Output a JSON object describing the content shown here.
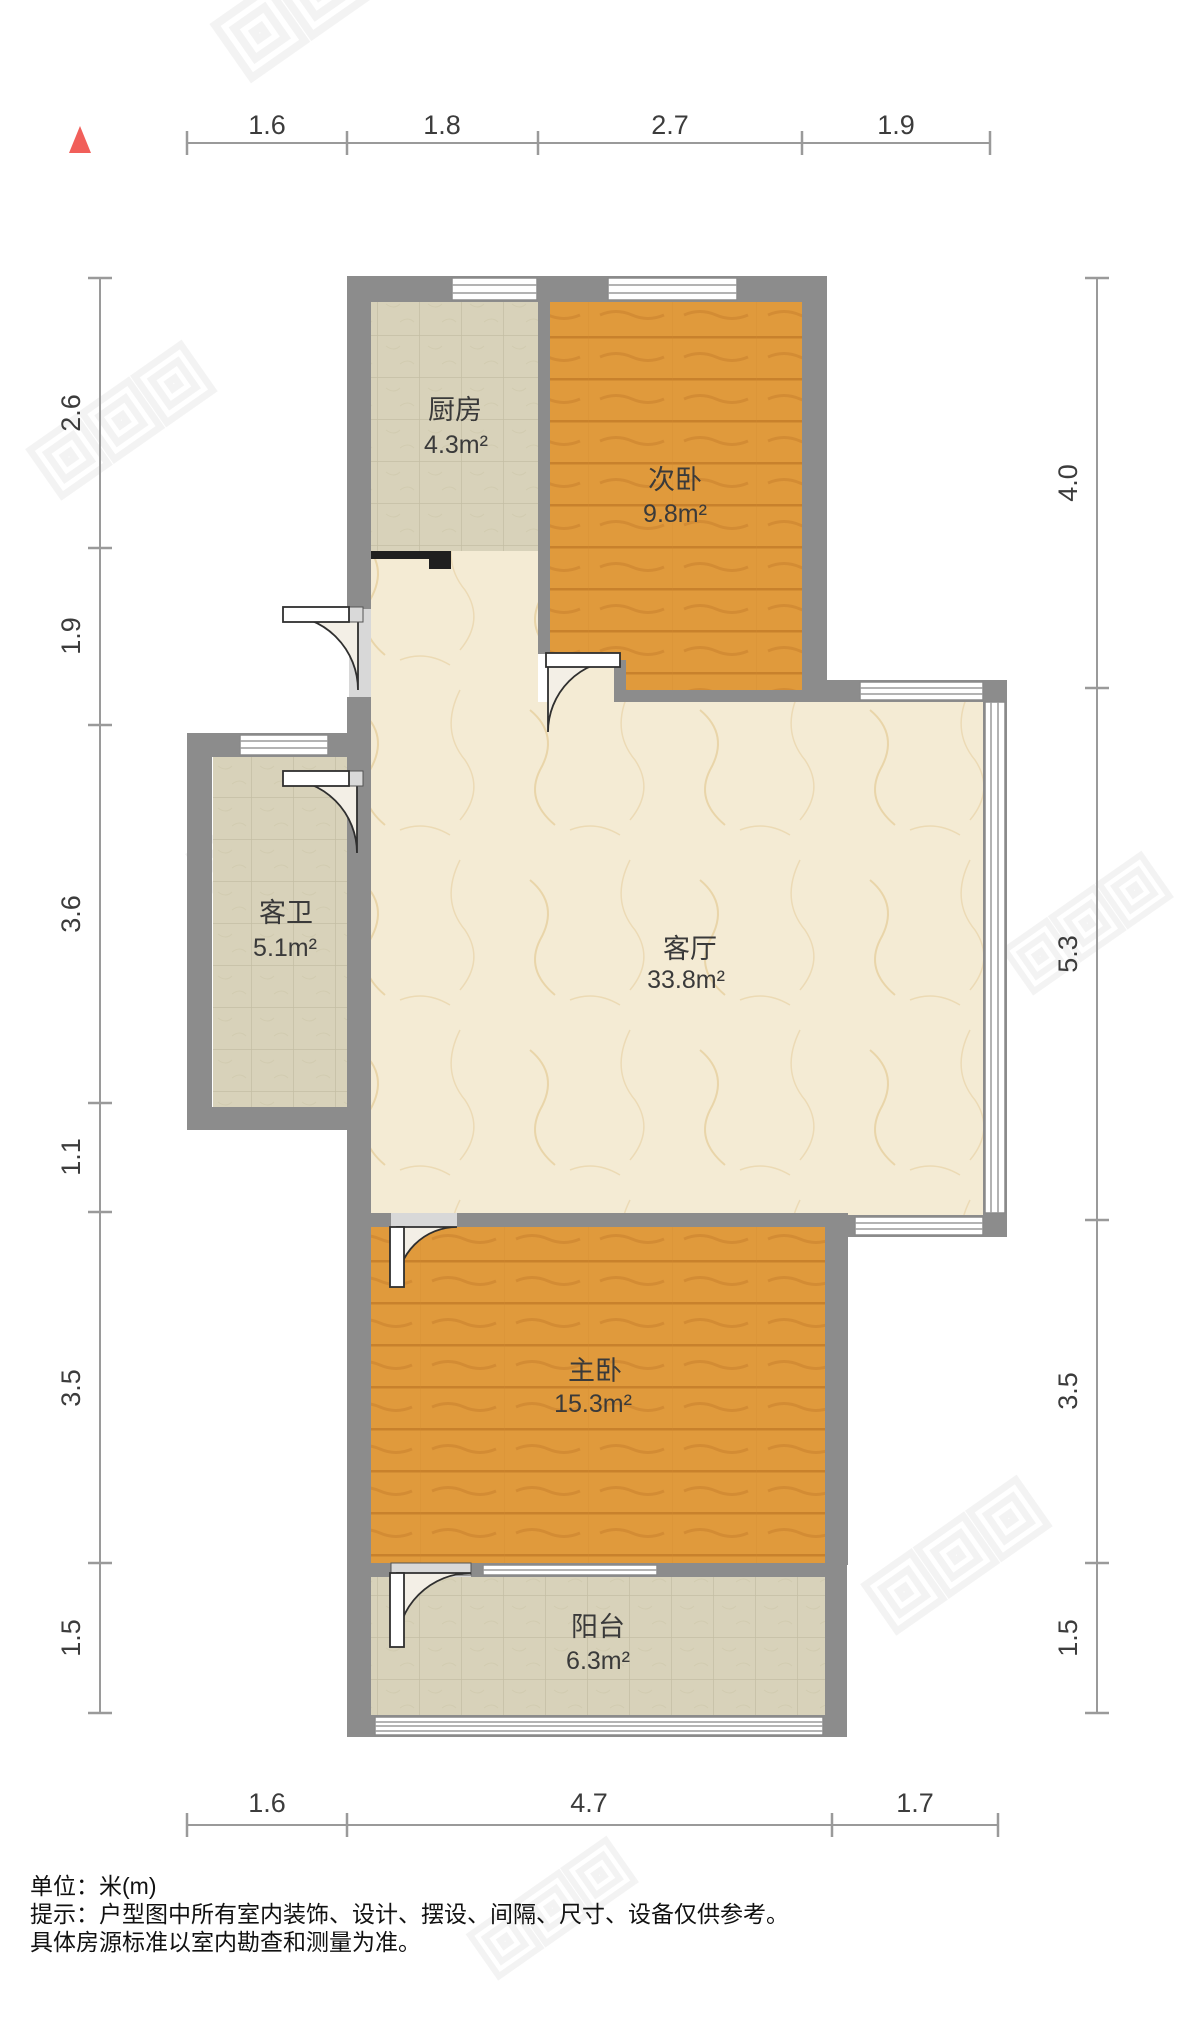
{
  "north_indicator": {
    "icon": "north-triangle-icon",
    "color": "#f15f5a"
  },
  "rooms": [
    {
      "name": "厨房",
      "area": "4.3m²"
    },
    {
      "name": "次卧",
      "area": "9.8m²"
    },
    {
      "name": "客卫",
      "area": "5.1m²"
    },
    {
      "name": "客厅",
      "area": "33.8m²"
    },
    {
      "name": "主卧",
      "area": "15.3m²"
    },
    {
      "name": "阳台",
      "area": "6.3m²"
    }
  ],
  "dimensions": {
    "top": [
      "1.6",
      "1.8",
      "2.7",
      "1.9"
    ],
    "left": [
      "2.6",
      "1.9",
      "3.6",
      "1.1",
      "3.5",
      "1.5"
    ],
    "right": [
      "4.0",
      "5.3",
      "3.5",
      "1.5"
    ],
    "bottom": [
      "1.6",
      "4.7",
      "1.7"
    ]
  },
  "footer": {
    "line1": "单位：米(m)",
    "line2": "提示：户型图中所有室内装饰、设计、摆设、间隔、尺寸、设备仅供参考。",
    "line3": "具体房源标准以室内勘查和测量为准。"
  },
  "colors": {
    "wall": "#8c8c8c",
    "accent_wall": "#1f1f1f",
    "wood_floor": "#e09a3c",
    "tile_floor": "#d7d1b8",
    "marble_floor": "#f4ebd3",
    "dimension_line": "#9a9a9a",
    "watermark": "#ebebeb"
  }
}
